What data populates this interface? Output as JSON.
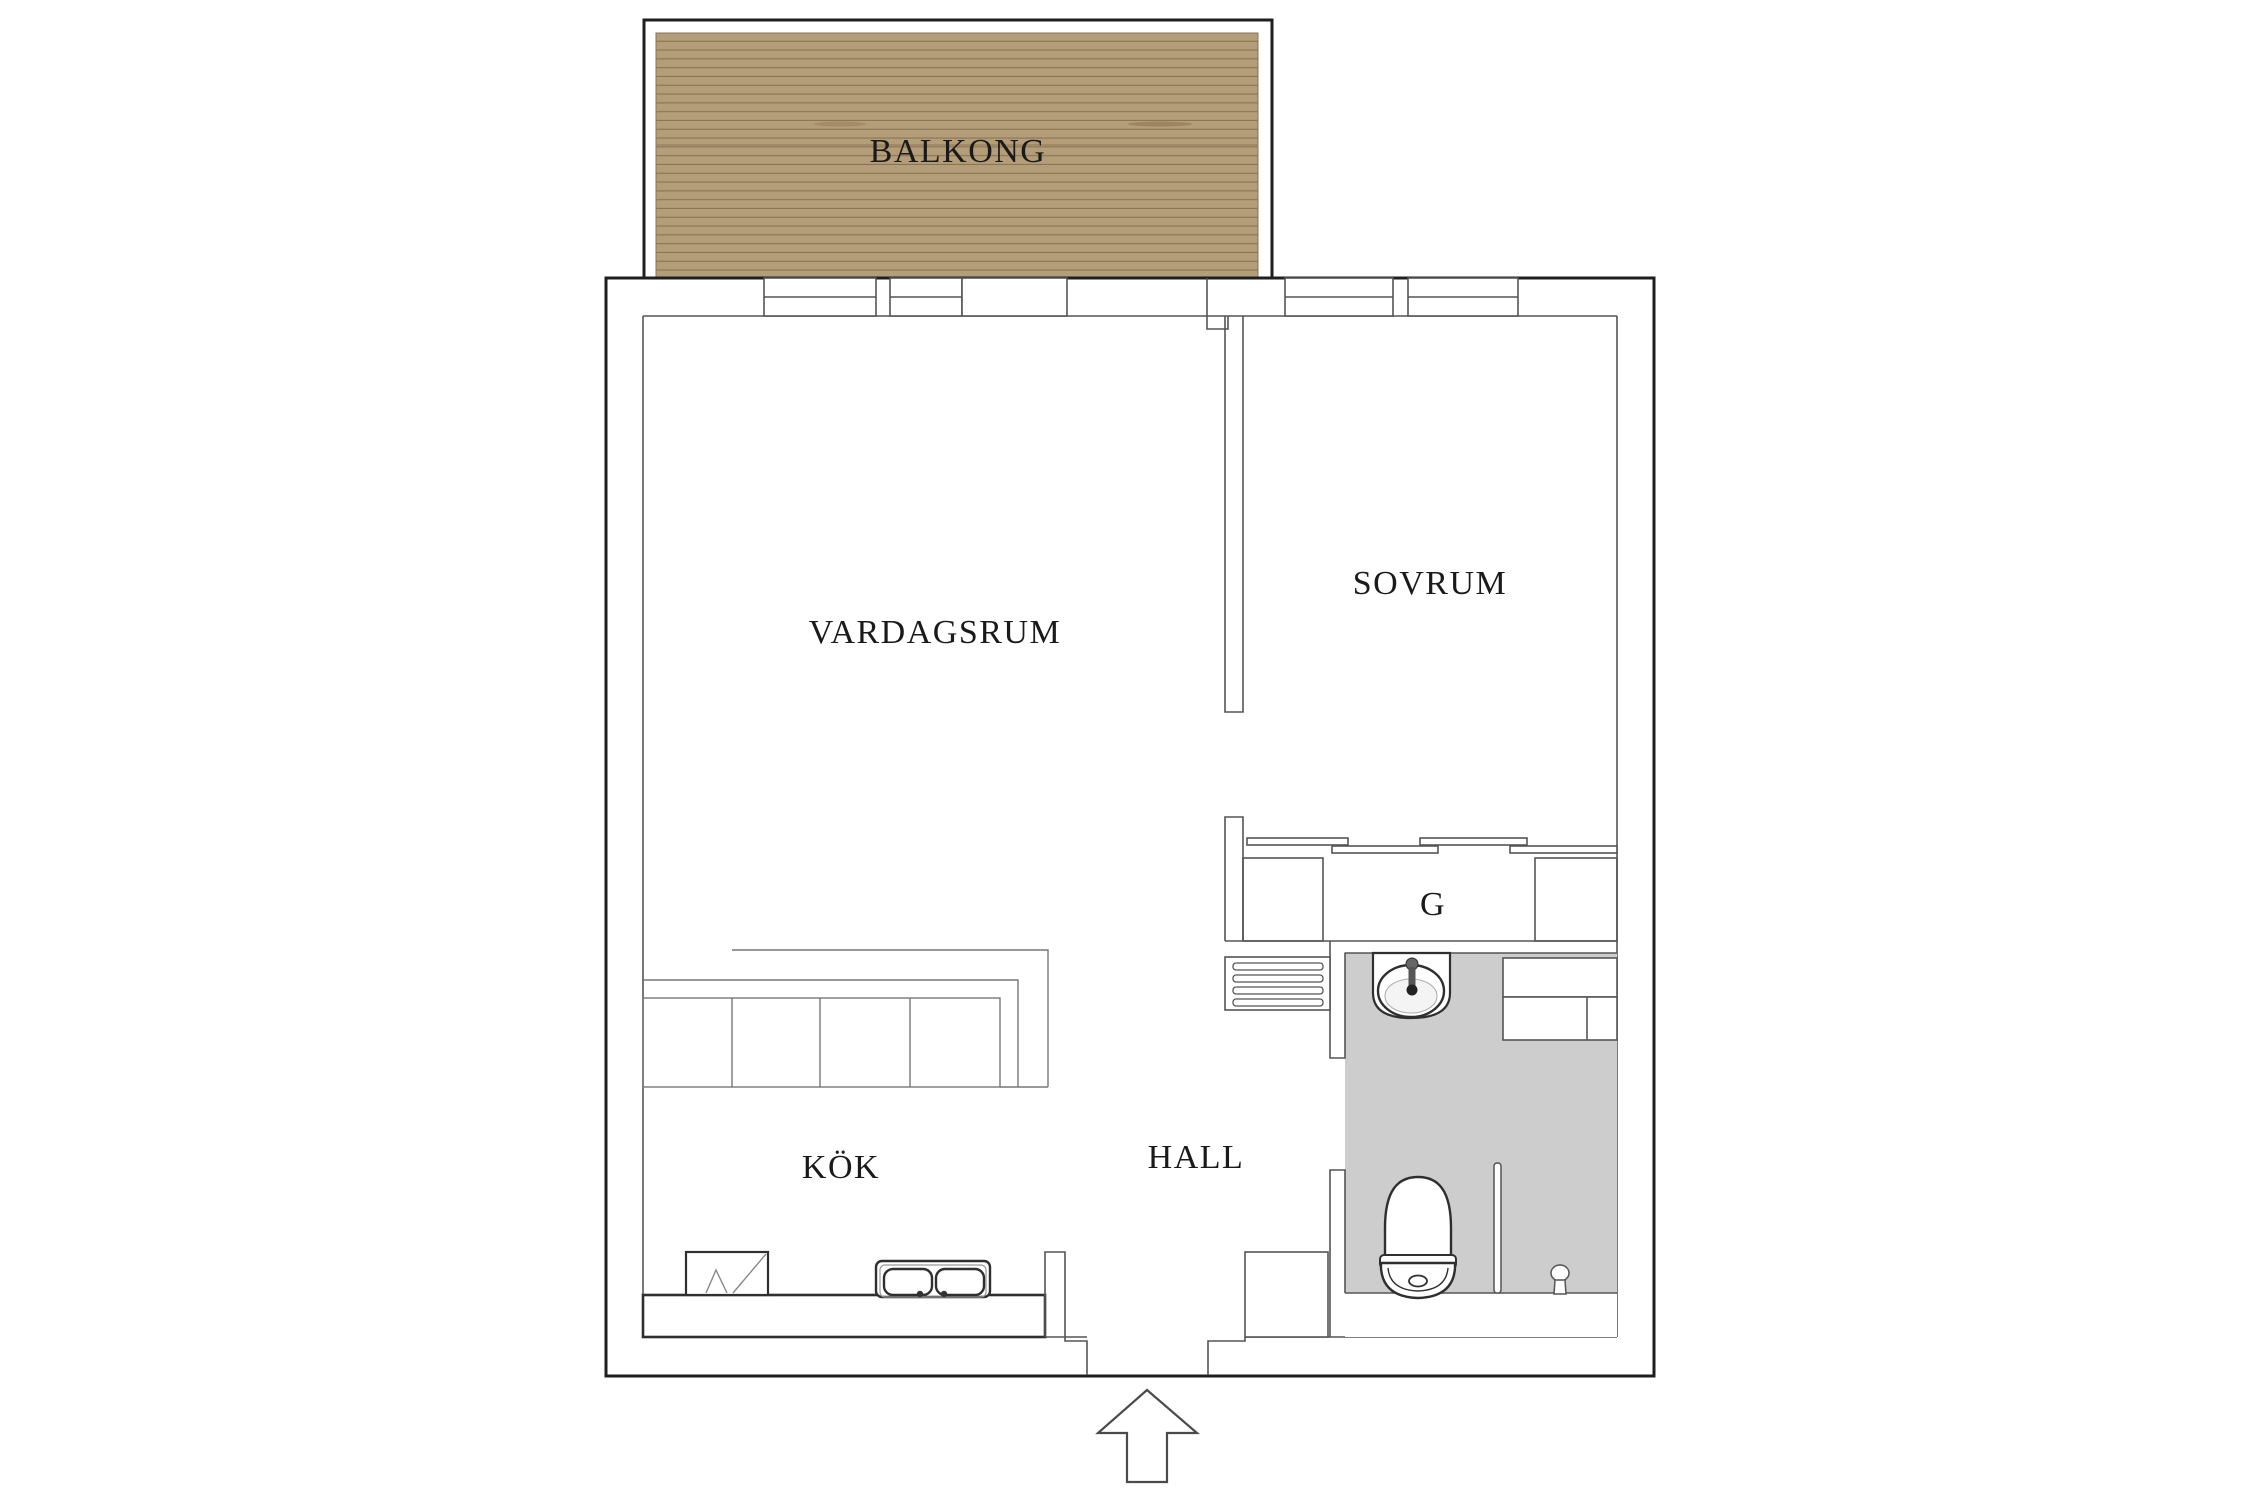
{
  "plan": {
    "type": "apartment-floor-plan",
    "rooms": {
      "balcony": {
        "label": "BALKONG"
      },
      "living": {
        "label": "VARDAGSRUM"
      },
      "bedroom": {
        "label": "SOVRUM"
      },
      "wardrobe": {
        "label": "G"
      },
      "kitchen": {
        "label": "KÖK"
      },
      "hall": {
        "label": "HALL"
      }
    },
    "fixtures": [
      "wood-deck",
      "window",
      "balcony-door-opening",
      "sliding-wardrobe-doors",
      "radiator",
      "bathroom-sink",
      "toilet",
      "shower-screen",
      "appliance-boxes",
      "kitchen-cabinets",
      "kitchen-counter",
      "cooktop-box",
      "double-sink",
      "hall-closet",
      "entrance-arrow"
    ],
    "colors": {
      "background": "#ffffff",
      "deck": "#b49d79",
      "deck_stripe": "#8b7354",
      "bathroom_floor": "#cdcdcd",
      "outer_wall_line": "#1f1f1f",
      "inner_wall_line": "#555555",
      "fixture_line": "#2f2f2f",
      "light_line": "#777777",
      "label_text": "#1a1a1a"
    }
  }
}
